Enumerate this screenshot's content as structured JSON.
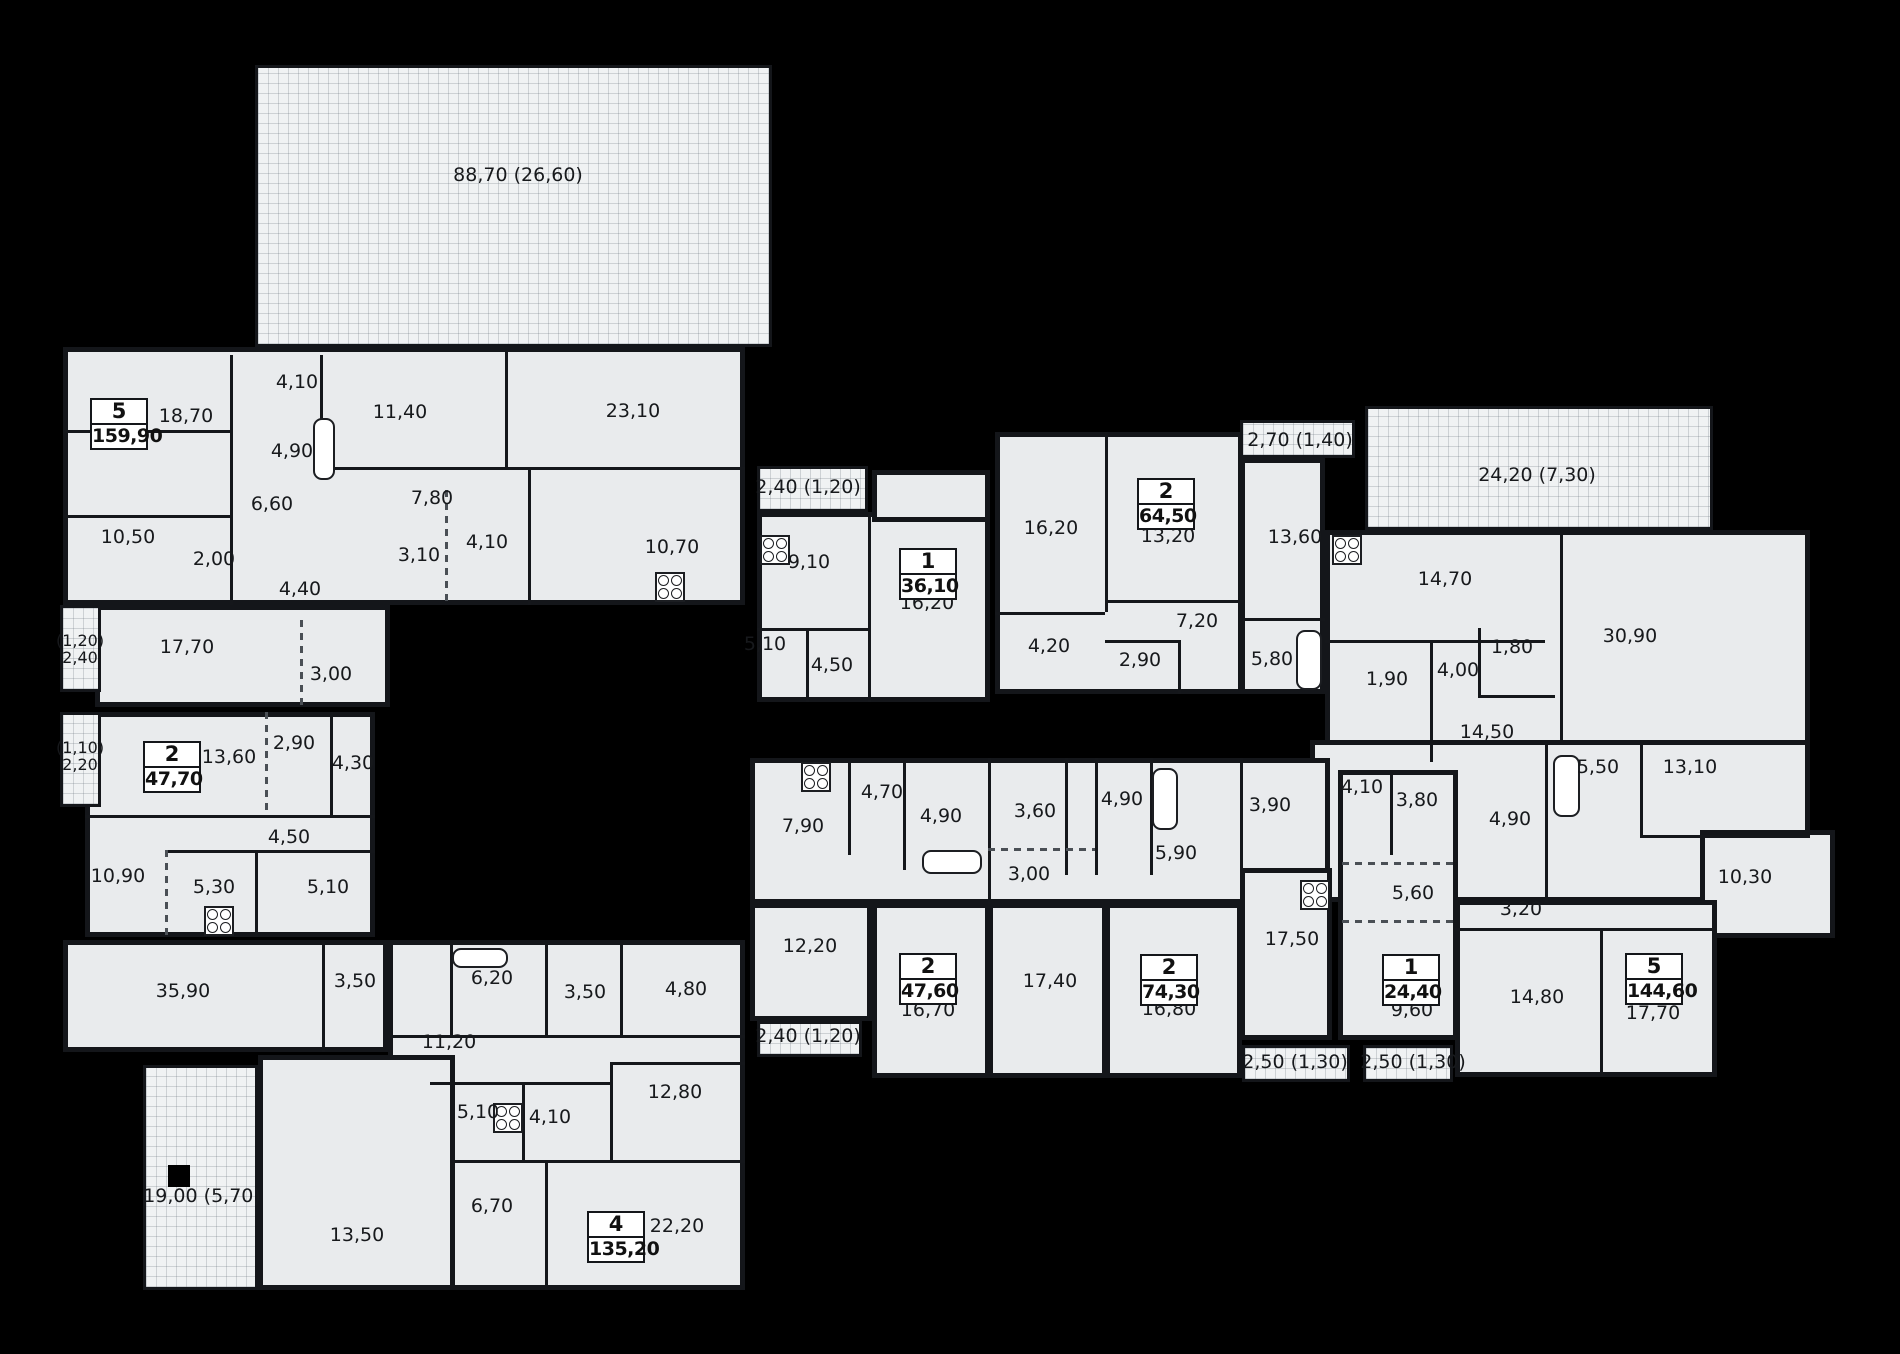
{
  "canvas": {
    "w": 1900,
    "h": 1354
  },
  "colors": {
    "background": "#000000",
    "floor": "#e9ebed",
    "terrace": "#f0f2f3",
    "wall": "#15171b",
    "text": "#17191c",
    "badge_bg": "#ffffff"
  },
  "blocks": [
    {
      "x": 63,
      "y": 347,
      "w": 682,
      "h": 258
    },
    {
      "x": 95,
      "y": 605,
      "w": 295,
      "h": 102
    },
    {
      "x": 757,
      "y": 512,
      "w": 233,
      "h": 190
    },
    {
      "x": 872,
      "y": 470,
      "w": 118,
      "h": 52
    },
    {
      "x": 995,
      "y": 432,
      "w": 248,
      "h": 262
    },
    {
      "x": 1240,
      "y": 458,
      "w": 85,
      "h": 236
    },
    {
      "x": 1325,
      "y": 530,
      "w": 485,
      "h": 232
    },
    {
      "x": 1310,
      "y": 740,
      "w": 500,
      "h": 162
    },
    {
      "x": 1700,
      "y": 830,
      "w": 135,
      "h": 108
    },
    {
      "x": 1455,
      "y": 900,
      "w": 262,
      "h": 177
    },
    {
      "x": 1338,
      "y": 770,
      "w": 120,
      "h": 270
    },
    {
      "x": 750,
      "y": 758,
      "w": 580,
      "h": 146
    },
    {
      "x": 750,
      "y": 903,
      "w": 122,
      "h": 118
    },
    {
      "x": 872,
      "y": 903,
      "w": 118,
      "h": 175
    },
    {
      "x": 988,
      "y": 903,
      "w": 119,
      "h": 175
    },
    {
      "x": 1105,
      "y": 903,
      "w": 137,
      "h": 175
    },
    {
      "x": 1240,
      "y": 868,
      "w": 92,
      "h": 172
    },
    {
      "x": 85,
      "y": 712,
      "w": 290,
      "h": 225
    },
    {
      "x": 63,
      "y": 940,
      "w": 325,
      "h": 112
    },
    {
      "x": 388,
      "y": 940,
      "w": 357,
      "h": 350
    },
    {
      "x": 258,
      "y": 1055,
      "w": 197,
      "h": 235
    }
  ],
  "terraces": [
    {
      "x": 255,
      "y": 65,
      "w": 517,
      "h": 282
    },
    {
      "x": 1365,
      "y": 406,
      "w": 348,
      "h": 124
    },
    {
      "x": 1240,
      "y": 420,
      "w": 115,
      "h": 38
    },
    {
      "x": 757,
      "y": 466,
      "w": 111,
      "h": 46
    },
    {
      "x": 60,
      "y": 605,
      "w": 41,
      "h": 87
    },
    {
      "x": 60,
      "y": 712,
      "w": 41,
      "h": 95
    },
    {
      "x": 757,
      "y": 1021,
      "w": 105,
      "h": 36
    },
    {
      "x": 1242,
      "y": 1045,
      "w": 108,
      "h": 37
    },
    {
      "x": 1363,
      "y": 1045,
      "w": 90,
      "h": 37
    },
    {
      "x": 143,
      "y": 1065,
      "w": 115,
      "h": 225
    }
  ],
  "walls": [
    {
      "x": 230,
      "y": 355,
      "w": 3,
      "h": 250
    },
    {
      "x": 320,
      "y": 355,
      "w": 3,
      "h": 112
    },
    {
      "x": 63,
      "y": 430,
      "w": 167,
      "h": 3
    },
    {
      "x": 505,
      "y": 350,
      "w": 3,
      "h": 117
    },
    {
      "x": 322,
      "y": 467,
      "w": 423,
      "h": 3
    },
    {
      "x": 63,
      "y": 515,
      "w": 167,
      "h": 3
    },
    {
      "x": 445,
      "y": 490,
      "w": 3,
      "h": 115,
      "d": 1
    },
    {
      "x": 528,
      "y": 467,
      "w": 3,
      "h": 138
    },
    {
      "x": 300,
      "y": 620,
      "w": 3,
      "h": 87,
      "d": 1
    },
    {
      "x": 868,
      "y": 512,
      "w": 3,
      "h": 190
    },
    {
      "x": 757,
      "y": 628,
      "w": 113,
      "h": 3
    },
    {
      "x": 806,
      "y": 628,
      "w": 3,
      "h": 74
    },
    {
      "x": 1105,
      "y": 432,
      "w": 3,
      "h": 180
    },
    {
      "x": 995,
      "y": 612,
      "w": 110,
      "h": 3
    },
    {
      "x": 1105,
      "y": 600,
      "w": 138,
      "h": 3
    },
    {
      "x": 1105,
      "y": 640,
      "w": 73,
      "h": 3
    },
    {
      "x": 1178,
      "y": 640,
      "w": 3,
      "h": 54
    },
    {
      "x": 1243,
      "y": 618,
      "w": 82,
      "h": 3
    },
    {
      "x": 1560,
      "y": 530,
      "w": 3,
      "h": 210
    },
    {
      "x": 1325,
      "y": 640,
      "w": 220,
      "h": 3
    },
    {
      "x": 1430,
      "y": 640,
      "w": 3,
      "h": 122
    },
    {
      "x": 1478,
      "y": 628,
      "w": 3,
      "h": 67
    },
    {
      "x": 1478,
      "y": 695,
      "w": 77,
      "h": 3
    },
    {
      "x": 1545,
      "y": 740,
      "w": 3,
      "h": 162
    },
    {
      "x": 1640,
      "y": 740,
      "w": 3,
      "h": 95
    },
    {
      "x": 1640,
      "y": 835,
      "w": 170,
      "h": 3
    },
    {
      "x": 1390,
      "y": 775,
      "w": 3,
      "h": 80
    },
    {
      "x": 1342,
      "y": 862,
      "w": 112,
      "h": 3,
      "d": 1
    },
    {
      "x": 1342,
      "y": 920,
      "w": 112,
      "h": 3,
      "d": 1
    },
    {
      "x": 1455,
      "y": 928,
      "w": 262,
      "h": 3
    },
    {
      "x": 1600,
      "y": 928,
      "w": 3,
      "h": 149
    },
    {
      "x": 848,
      "y": 762,
      "w": 3,
      "h": 93
    },
    {
      "x": 903,
      "y": 762,
      "w": 3,
      "h": 108
    },
    {
      "x": 988,
      "y": 758,
      "w": 3,
      "h": 146
    },
    {
      "x": 1065,
      "y": 758,
      "w": 3,
      "h": 117
    },
    {
      "x": 1095,
      "y": 758,
      "w": 3,
      "h": 117
    },
    {
      "x": 1150,
      "y": 758,
      "w": 3,
      "h": 117
    },
    {
      "x": 1240,
      "y": 758,
      "w": 3,
      "h": 112
    },
    {
      "x": 988,
      "y": 848,
      "w": 107,
      "h": 3,
      "d": 1
    },
    {
      "x": 265,
      "y": 712,
      "w": 3,
      "h": 103,
      "d": 1
    },
    {
      "x": 330,
      "y": 712,
      "w": 3,
      "h": 103
    },
    {
      "x": 85,
      "y": 815,
      "w": 290,
      "h": 3
    },
    {
      "x": 165,
      "y": 850,
      "w": 210,
      "h": 3
    },
    {
      "x": 165,
      "y": 850,
      "w": 3,
      "h": 87,
      "d": 1
    },
    {
      "x": 255,
      "y": 850,
      "w": 3,
      "h": 87
    },
    {
      "x": 322,
      "y": 940,
      "w": 3,
      "h": 112
    },
    {
      "x": 450,
      "y": 945,
      "w": 3,
      "h": 92
    },
    {
      "x": 545,
      "y": 945,
      "w": 3,
      "h": 92
    },
    {
      "x": 620,
      "y": 945,
      "w": 3,
      "h": 92
    },
    {
      "x": 388,
      "y": 1035,
      "w": 357,
      "h": 3
    },
    {
      "x": 610,
      "y": 1062,
      "w": 135,
      "h": 3
    },
    {
      "x": 610,
      "y": 1062,
      "w": 3,
      "h": 100
    },
    {
      "x": 430,
      "y": 1082,
      "w": 180,
      "h": 3
    },
    {
      "x": 522,
      "y": 1082,
      "w": 3,
      "h": 80
    },
    {
      "x": 455,
      "y": 1160,
      "w": 290,
      "h": 3
    },
    {
      "x": 545,
      "y": 1160,
      "w": 3,
      "h": 130
    }
  ],
  "rooms": [
    {
      "t": "18,70",
      "x": 186,
      "y": 417
    },
    {
      "t": "4,10",
      "x": 297,
      "y": 383
    },
    {
      "t": "11,40",
      "x": 400,
      "y": 413
    },
    {
      "t": "23,10",
      "x": 633,
      "y": 412
    },
    {
      "t": "4,90",
      "x": 292,
      "y": 452
    },
    {
      "t": "6,60",
      "x": 272,
      "y": 505
    },
    {
      "t": "7,80",
      "x": 432,
      "y": 499
    },
    {
      "t": "10,50",
      "x": 128,
      "y": 538
    },
    {
      "t": "2,00",
      "x": 214,
      "y": 560
    },
    {
      "t": "3,10",
      "x": 419,
      "y": 556
    },
    {
      "t": "4,10",
      "x": 487,
      "y": 543
    },
    {
      "t": "10,70",
      "x": 672,
      "y": 548
    },
    {
      "t": "4,40",
      "x": 300,
      "y": 590
    },
    {
      "t": "17,70",
      "x": 187,
      "y": 648
    },
    {
      "t": "3,00",
      "x": 331,
      "y": 675
    },
    {
      "t": "9,10",
      "x": 809,
      "y": 563
    },
    {
      "t": "16,20",
      "x": 927,
      "y": 604
    },
    {
      "t": "5,10",
      "x": 765,
      "y": 645
    },
    {
      "t": "4,50",
      "x": 832,
      "y": 666
    },
    {
      "t": "16,20",
      "x": 1051,
      "y": 529
    },
    {
      "t": "13,20",
      "x": 1168,
      "y": 537
    },
    {
      "t": "13,60",
      "x": 1295,
      "y": 538
    },
    {
      "t": "7,20",
      "x": 1197,
      "y": 622
    },
    {
      "t": "4,20",
      "x": 1049,
      "y": 647
    },
    {
      "t": "2,90",
      "x": 1140,
      "y": 661
    },
    {
      "t": "5,80",
      "x": 1272,
      "y": 660
    },
    {
      "t": "14,70",
      "x": 1445,
      "y": 580
    },
    {
      "t": "30,90",
      "x": 1630,
      "y": 637
    },
    {
      "t": "1,80",
      "x": 1512,
      "y": 648
    },
    {
      "t": "4,00",
      "x": 1458,
      "y": 671
    },
    {
      "t": "1,90",
      "x": 1387,
      "y": 680
    },
    {
      "t": "14,50",
      "x": 1487,
      "y": 733
    },
    {
      "t": "5,50",
      "x": 1598,
      "y": 768
    },
    {
      "t": "13,10",
      "x": 1690,
      "y": 768
    },
    {
      "t": "4,10",
      "x": 1362,
      "y": 788
    },
    {
      "t": "3,80",
      "x": 1417,
      "y": 801
    },
    {
      "t": "4,90",
      "x": 1510,
      "y": 820
    },
    {
      "t": "5,60",
      "x": 1413,
      "y": 894
    },
    {
      "t": "10,30",
      "x": 1745,
      "y": 878
    },
    {
      "t": "3,20",
      "x": 1521,
      "y": 910
    },
    {
      "t": "14,80",
      "x": 1537,
      "y": 998
    },
    {
      "t": "17,70",
      "x": 1653,
      "y": 1014
    },
    {
      "t": "9,60",
      "x": 1412,
      "y": 1011
    },
    {
      "t": "7,90",
      "x": 803,
      "y": 827
    },
    {
      "t": "4,70",
      "x": 882,
      "y": 793
    },
    {
      "t": "4,90",
      "x": 941,
      "y": 817
    },
    {
      "t": "3,60",
      "x": 1035,
      "y": 812
    },
    {
      "t": "3,00",
      "x": 1029,
      "y": 875
    },
    {
      "t": "4,90",
      "x": 1122,
      "y": 800
    },
    {
      "t": "5,90",
      "x": 1176,
      "y": 854
    },
    {
      "t": "3,90",
      "x": 1270,
      "y": 806
    },
    {
      "t": "17,50",
      "x": 1292,
      "y": 940
    },
    {
      "t": "12,20",
      "x": 810,
      "y": 947
    },
    {
      "t": "16,70",
      "x": 928,
      "y": 1011
    },
    {
      "t": "17,40",
      "x": 1050,
      "y": 982
    },
    {
      "t": "16,80",
      "x": 1169,
      "y": 1010
    },
    {
      "t": "13,60",
      "x": 229,
      "y": 758
    },
    {
      "t": "2,90",
      "x": 294,
      "y": 744
    },
    {
      "t": "4,30",
      "x": 353,
      "y": 764
    },
    {
      "t": "4,50",
      "x": 289,
      "y": 838
    },
    {
      "t": "10,90",
      "x": 118,
      "y": 877
    },
    {
      "t": "5,30",
      "x": 214,
      "y": 888
    },
    {
      "t": "5,10",
      "x": 328,
      "y": 888
    },
    {
      "t": "35,90",
      "x": 183,
      "y": 992
    },
    {
      "t": "3,50",
      "x": 355,
      "y": 982
    },
    {
      "t": "6,20",
      "x": 492,
      "y": 979
    },
    {
      "t": "3,50",
      "x": 585,
      "y": 993
    },
    {
      "t": "4,80",
      "x": 686,
      "y": 990
    },
    {
      "t": "11,20",
      "x": 449,
      "y": 1043
    },
    {
      "t": "12,80",
      "x": 675,
      "y": 1093
    },
    {
      "t": "5,10",
      "x": 478,
      "y": 1113
    },
    {
      "t": "4,10",
      "x": 550,
      "y": 1118
    },
    {
      "t": "6,70",
      "x": 492,
      "y": 1207
    },
    {
      "t": "13,50",
      "x": 357,
      "y": 1236
    },
    {
      "t": "22,20",
      "x": 677,
      "y": 1227
    }
  ],
  "terrace_rooms": [
    {
      "t": "88,70 (26,60)",
      "x": 518,
      "y": 176
    },
    {
      "t": "24,20 (7,30)",
      "x": 1537,
      "y": 476
    },
    {
      "t": "2,70 (1,40)",
      "x": 1300,
      "y": 441
    },
    {
      "t": "2,40 (1,20)",
      "x": 808,
      "y": 488
    },
    {
      "t": "2,40 (1,20)",
      "x": 808,
      "y": 1037
    },
    {
      "t": "2,50 (1,30)",
      "x": 1295,
      "y": 1063
    },
    {
      "t": "2,50 (1,30)",
      "x": 1413,
      "y": 1063
    },
    {
      "t": "19,00 (5,70)",
      "x": 202,
      "y": 1197
    },
    {
      "t": "(1,20)",
      "t2": "2,40",
      "x": 80,
      "y": 650
    },
    {
      "t": "(1,10)",
      "t2": "2,20",
      "x": 80,
      "y": 757
    }
  ],
  "apartments": [
    {
      "rooms": "5",
      "area": "159,90",
      "x": 90,
      "y": 398
    },
    {
      "rooms": "1",
      "area": "36,10",
      "x": 899,
      "y": 548
    },
    {
      "rooms": "2",
      "area": "64,50",
      "x": 1137,
      "y": 478
    },
    {
      "rooms": "2",
      "area": "47,70",
      "x": 143,
      "y": 741
    },
    {
      "rooms": "2",
      "area": "47,60",
      "x": 899,
      "y": 953
    },
    {
      "rooms": "2",
      "area": "74,30",
      "x": 1140,
      "y": 954
    },
    {
      "rooms": "1",
      "area": "24,40",
      "x": 1382,
      "y": 954
    },
    {
      "rooms": "5",
      "area": "144,60",
      "x": 1625,
      "y": 953
    },
    {
      "rooms": "4",
      "area": "135,20",
      "x": 587,
      "y": 1211
    }
  ],
  "fixtures": [
    {
      "k": "stove",
      "x": 760,
      "y": 535
    },
    {
      "k": "stove",
      "x": 1332,
      "y": 535
    },
    {
      "k": "stove",
      "x": 655,
      "y": 572
    },
    {
      "k": "stove",
      "x": 204,
      "y": 906
    },
    {
      "k": "stove",
      "x": 493,
      "y": 1103
    },
    {
      "k": "stove",
      "x": 1300,
      "y": 880
    },
    {
      "k": "stove",
      "x": 801,
      "y": 762
    },
    {
      "k": "tub",
      "x": 313,
      "y": 418,
      "w": 22,
      "h": 62
    },
    {
      "k": "tub",
      "x": 1296,
      "y": 630,
      "w": 26,
      "h": 60
    },
    {
      "k": "tub",
      "x": 1553,
      "y": 755,
      "w": 27,
      "h": 62
    },
    {
      "k": "tub",
      "x": 1152,
      "y": 768,
      "w": 26,
      "h": 62
    },
    {
      "k": "tub",
      "x": 922,
      "y": 850,
      "w": 60,
      "h": 24
    },
    {
      "k": "tub",
      "x": 452,
      "y": 948,
      "w": 56,
      "h": 20
    },
    {
      "k": "sq",
      "x": 168,
      "y": 1165,
      "w": 22,
      "h": 22
    }
  ]
}
